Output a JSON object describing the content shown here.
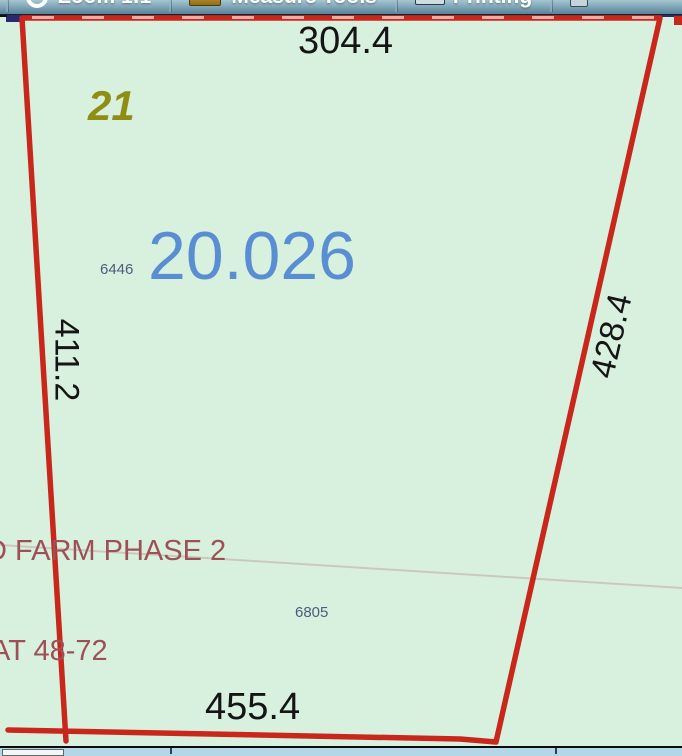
{
  "toolbar": {
    "buttons": [
      {
        "label": "Zoom 1:1",
        "icon": "magnifier-icon"
      },
      {
        "label": "Measure Tools",
        "icon": "ruler-icon"
      },
      {
        "label": "Printing",
        "icon": "printer-icon"
      }
    ]
  },
  "map": {
    "lot_number": "21",
    "acreage": "20.026",
    "parcel_id_1": "6446",
    "parcel_id_2": "6805",
    "boundary_lengths": {
      "top": "304.4",
      "left": "411.2",
      "right": "428.4",
      "bottom": "455.4"
    },
    "subdivision_label": "D FARM PHASE 2",
    "plat_label": "AT 48-72",
    "colors": {
      "parcel_boundary": "#c9271b",
      "background": "#d7f1de",
      "acreage_text": "#5a8ed2",
      "lot_number_text": "#8f8d12",
      "plat_text": "#9d5156",
      "parcel_id_text": "#4d5c7d",
      "adjacent_boundary": "#2a2a72"
    }
  }
}
